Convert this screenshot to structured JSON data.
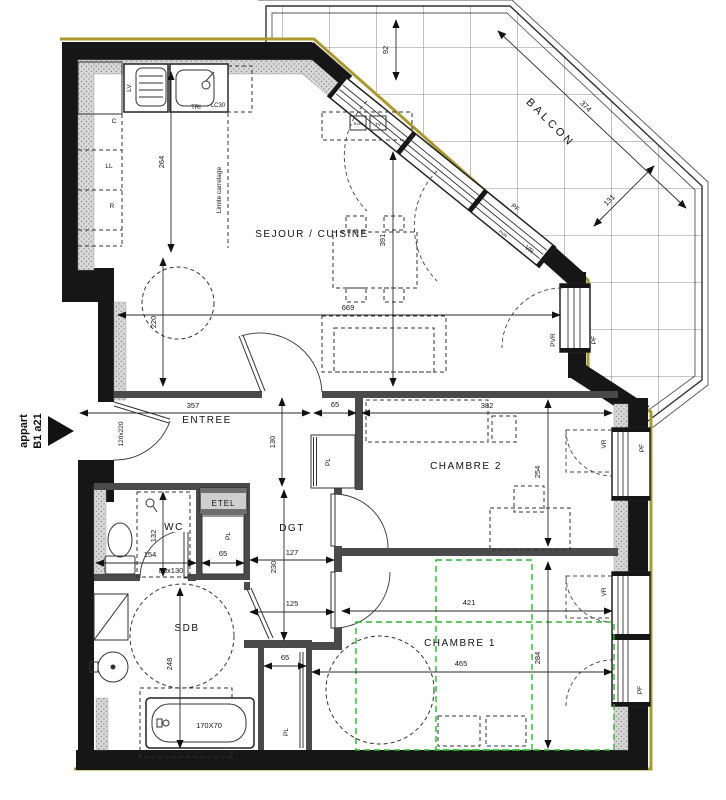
{
  "apartment": {
    "line1": "appart",
    "line2": "B1 a21"
  },
  "rooms": {
    "sejour": "SEJOUR / CUISINE",
    "balcon": "BALCON",
    "entree": "ENTREE",
    "dgt": "DGT",
    "wc": "WC",
    "sdb": "SDB",
    "chambre1": "CHAMBRE 1",
    "chambre2": "CHAMBRE 2"
  },
  "kitchen": {
    "lv": "LV",
    "tri": "TRI",
    "lc30": "LC30",
    "c": "C",
    "ll": "LL",
    "r": "R",
    "limite": "Limite carrelage",
    "rj45": "RJ45",
    "tv": "TV"
  },
  "labels": {
    "etel": "ETEL",
    "pl": "PL",
    "pf": "PF",
    "vr": "VR",
    "pvr": "PVR",
    "door_size": "120x220",
    "shower_size": "80x130",
    "bath_size": "170X70"
  },
  "dims": {
    "d92": "92",
    "d131": "131",
    "d374": "374",
    "d264": "264",
    "d220": "220",
    "d391": "391",
    "d669": "669",
    "d357": "357",
    "d65": "65",
    "d382": "382",
    "d130": "130",
    "d254": "254",
    "d127": "127",
    "d230": "230",
    "d132": "132",
    "d154": "154",
    "d125": "125",
    "d248": "248",
    "d284": "284",
    "d421": "421",
    "d465": "465"
  },
  "colors": {
    "wall": "#161616",
    "partition": "#4a4a4a",
    "facade": "#ab992d",
    "green": "#2db52d",
    "line": "#2a2a2a"
  }
}
